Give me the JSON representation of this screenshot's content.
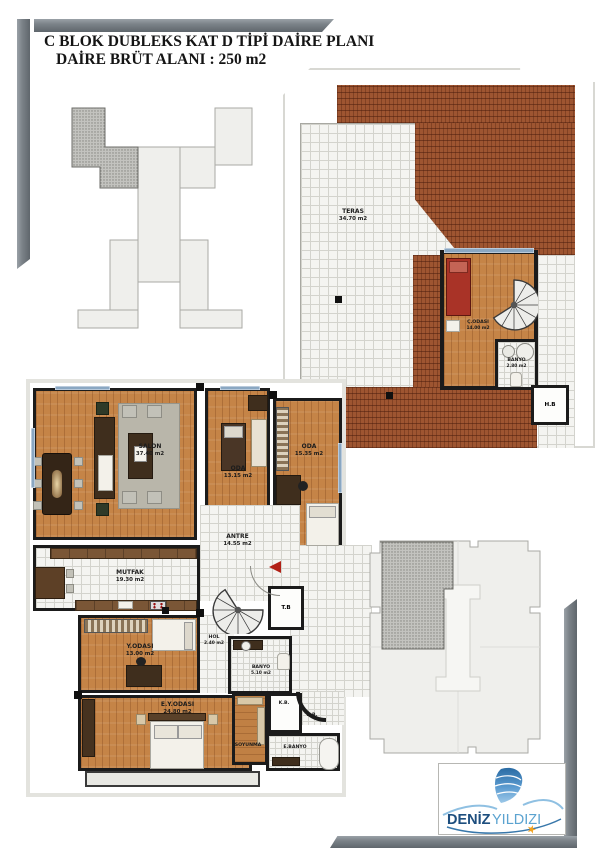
{
  "title": {
    "line1": "C BLOK DUBLEKS KAT D TİPİ DAİRE PLANI",
    "line2": "DAİRE BRÜT ALANI : 250 m2"
  },
  "upper_plan": {
    "teras": {
      "name": "TERAS",
      "area": "34.70 m2"
    },
    "c_odasi": {
      "name": "Ç.ODASI",
      "area": "14.00 m2"
    },
    "banyo": {
      "name": "BANYO",
      "area": "2.80 m2"
    },
    "hb": {
      "name": "H.B"
    }
  },
  "main_plan": {
    "salon": {
      "name": "SALON",
      "area": "37.40 m2"
    },
    "oda1": {
      "name": "ODA",
      "area": "13.15 m2"
    },
    "oda2": {
      "name": "ODA",
      "area": "15.35 m2"
    },
    "antre": {
      "name": "ANTRE",
      "area": "14.55 m2"
    },
    "mutfak": {
      "name": "MUTFAK",
      "area": "19.30 m2"
    },
    "y_odasi": {
      "name": "Y.ODASI",
      "area": "13.00 m2"
    },
    "hol": {
      "name": "HOL",
      "area": "2.40 m2"
    },
    "tb": {
      "name": "T.B"
    },
    "banyo": {
      "name": "BANYO",
      "area": "5.10 m2"
    },
    "ey_odasi": {
      "name": "E.Y.ODASI",
      "area": "24.80 m2"
    },
    "soyunma": {
      "name": "SOYUNMA"
    },
    "e_banyo": {
      "name": "E.BANYO"
    },
    "kb1": {
      "name": "K.B."
    },
    "kb2": {
      "name": "K.B."
    }
  },
  "logo": {
    "brand_primary": "DENİZ",
    "brand_secondary": "YILDIZI",
    "star_glyph": "★"
  },
  "colors": {
    "wall": "#1b1b1b",
    "brick": "#9e5531",
    "wood": "#c58447",
    "tile_line": "#d3d3cd",
    "frame_gray": "#70777d",
    "logo_dark_blue": "#1d4e7e",
    "logo_light_blue": "#5ba3d0",
    "star_orange": "#f2a11d",
    "accent_red": "#b22016"
  }
}
